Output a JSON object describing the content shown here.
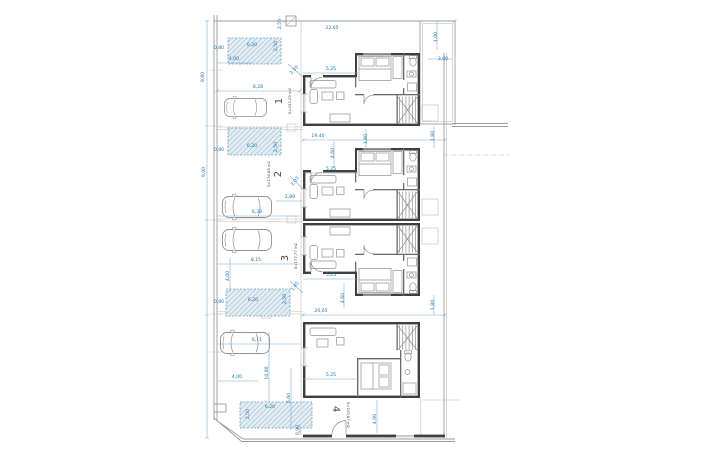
{
  "drawing": {
    "kind": "architectural site / floor plan",
    "palette": {
      "dimension_text": "#2272ad",
      "dimension_line": "#7aa7c7",
      "wall": "#3f3f3f",
      "hatch_bg": "#e7eef3",
      "hatch_line": "#adc9d9",
      "hatch_border": "#6fa0c4"
    },
    "units": [
      {
        "number": "1",
        "area_label": "S=233,29 m2",
        "nx": 282,
        "ny": 101,
        "ax": 291,
        "ay": 101,
        "r": -90
      },
      {
        "number": "2",
        "area_label": "S=176,68 m2",
        "nx": 281,
        "ny": 174,
        "ax": 270,
        "ay": 174,
        "r": -90
      },
      {
        "number": "3",
        "area_label": "S=177,77 m2",
        "nx": 288,
        "ny": 258,
        "ax": 297,
        "ay": 256,
        "r": -90
      },
      {
        "number": "4",
        "area_label": "S=245,87 m2",
        "nx": 333,
        "ny": 409,
        "ax": 347,
        "ay": 415,
        "r": 90
      }
    ],
    "dimensions": [
      {
        "t": "22,65",
        "x": 332,
        "y": 29,
        "r": 0
      },
      {
        "t": "2,50",
        "x": 281,
        "y": 24,
        "r": -90
      },
      {
        "t": "1,00",
        "x": 437,
        "y": 37,
        "r": -90
      },
      {
        "t": "3,00",
        "x": 443,
        "y": 60,
        "r": 0
      },
      {
        "t": "0,80",
        "x": 219,
        "y": 49,
        "r": 0
      },
      {
        "t": "6,20",
        "x": 252,
        "y": 46,
        "r": 0
      },
      {
        "t": "2,50",
        "x": 277,
        "y": 46,
        "r": -90
      },
      {
        "t": "4,00",
        "x": 234,
        "y": 60,
        "r": 0
      },
      {
        "t": "9,80",
        "x": 204,
        "y": 77,
        "r": -90
      },
      {
        "t": "5,25",
        "x": 331,
        "y": 70,
        "r": 0
      },
      {
        "t": "2,50",
        "x": 295,
        "y": 71,
        "r": -48
      },
      {
        "t": "8,28",
        "x": 258,
        "y": 88,
        "r": 0
      },
      {
        "t": "19,40",
        "x": 318,
        "y": 137,
        "r": 0
      },
      {
        "t": "1,80",
        "x": 367,
        "y": 139,
        "r": -90
      },
      {
        "t": "1,80",
        "x": 434,
        "y": 136,
        "r": -90
      },
      {
        "t": "0,80",
        "x": 219,
        "y": 151,
        "r": 0
      },
      {
        "t": "6,20",
        "x": 252,
        "y": 147,
        "r": 0
      },
      {
        "t": "2,50",
        "x": 277,
        "y": 147,
        "r": -90
      },
      {
        "t": "4,60",
        "x": 334,
        "y": 153,
        "r": -90
      },
      {
        "t": "5,25",
        "x": 331,
        "y": 170,
        "r": 0
      },
      {
        "t": "2,03",
        "x": 296,
        "y": 182,
        "r": -52
      },
      {
        "t": "9,00",
        "x": 205,
        "y": 172,
        "r": -90
      },
      {
        "t": "2,89",
        "x": 290,
        "y": 198,
        "r": 0
      },
      {
        "t": "8,39",
        "x": 257,
        "y": 213,
        "r": 0
      },
      {
        "t": "8,15",
        "x": 256,
        "y": 261,
        "r": 0
      },
      {
        "t": "5,25",
        "x": 331,
        "y": 276,
        "r": 0
      },
      {
        "t": "1,45",
        "x": 296,
        "y": 287,
        "r": -52
      },
      {
        "t": "4,60",
        "x": 344,
        "y": 298,
        "r": -90
      },
      {
        "t": "4,00",
        "x": 229,
        "y": 276,
        "r": -90
      },
      {
        "t": "1,80",
        "x": 434,
        "y": 305,
        "r": -90
      },
      {
        "t": "0,80",
        "x": 219,
        "y": 303,
        "r": 0
      },
      {
        "t": "6,20",
        "x": 253,
        "y": 301,
        "r": 0
      },
      {
        "t": "2,50",
        "x": 286,
        "y": 299,
        "r": -90
      },
      {
        "t": "20,65",
        "x": 321,
        "y": 312,
        "r": 0
      },
      {
        "t": "8,11",
        "x": 257,
        "y": 341,
        "r": 0
      },
      {
        "t": "4,00",
        "x": 237,
        "y": 378,
        "r": 0
      },
      {
        "t": "10,90",
        "x": 268,
        "y": 373,
        "r": -90
      },
      {
        "t": "6,60",
        "x": 290,
        "y": 398,
        "r": -90
      },
      {
        "t": "2,50",
        "x": 249,
        "y": 414,
        "r": -90
      },
      {
        "t": "6,20",
        "x": 270,
        "y": 408,
        "r": 0
      },
      {
        "t": "0,90",
        "x": 299,
        "y": 430,
        "r": -90
      },
      {
        "t": "5,25",
        "x": 331,
        "y": 376,
        "r": 0
      },
      {
        "t": "4,00",
        "x": 376,
        "y": 419,
        "r": -90
      }
    ]
  }
}
